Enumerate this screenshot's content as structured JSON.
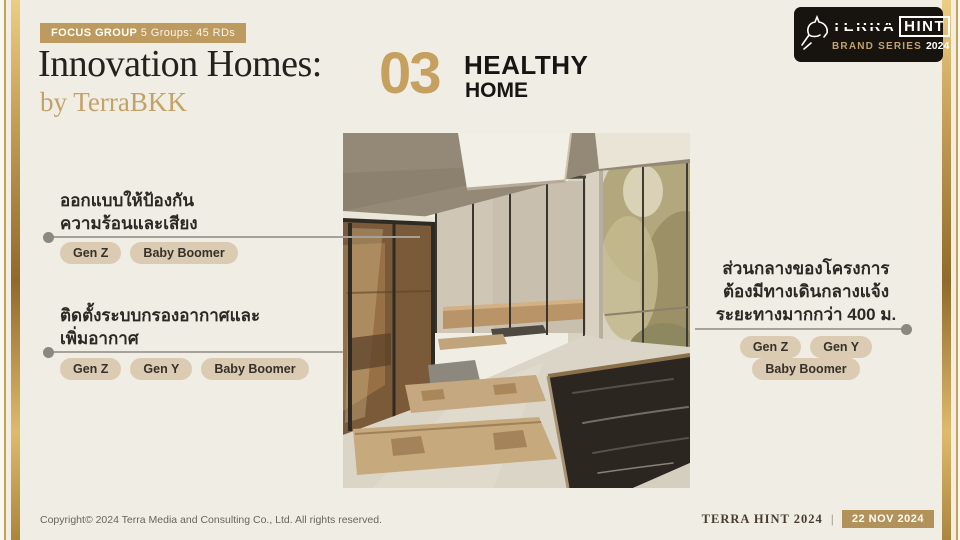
{
  "slide": {
    "badge": {
      "bold": "FOCUS GROUP",
      "rest": "5 Groups: 45 RDs"
    },
    "title": "Innovation Homes:",
    "subtitle": "by TerraBKK",
    "section_number": "03",
    "section_title_line1": "HEALTHY",
    "section_title_line2": "HOME"
  },
  "logo": {
    "terra": "TERRA",
    "hint": "HINT",
    "series": "BRAND SERIES",
    "year": "2024"
  },
  "annotations": {
    "left1": {
      "line1": "ออกแบบให้ป้องกัน",
      "line2": "ความร้อนและเสียง",
      "tags": [
        "Gen Z",
        "Baby Boomer"
      ]
    },
    "left2": {
      "line1": "ติดตั้งระบบกรองอากาศและ",
      "line2": "เพิ่มอากาศ",
      "tags": [
        "Gen Z",
        "Gen Y",
        "Baby Boomer"
      ]
    },
    "right1": {
      "line1": "ส่วนกลางของโครงการ",
      "line2": "ต้องมีทางเดินกลางแจ้ง",
      "line3": "ระยะทางมากกว่า 400 ม.",
      "tags": [
        "Gen Z",
        "Gen Y",
        "Baby Boomer"
      ]
    }
  },
  "footer": {
    "copyright": "Copyright© 2024 Terra Media and Consulting Co., Ltd. All rights reserved.",
    "brand": "TERRA HINT 2024",
    "divider": "|",
    "date": "22 NOV 2024"
  },
  "colors": {
    "gold_badge": "#BD9A60",
    "gold_number": "#C5A05F",
    "gold_serif": "#C3A268",
    "background": "#F0EDE5",
    "pill": "#DBCBB2",
    "dark_text": "#24221E"
  }
}
